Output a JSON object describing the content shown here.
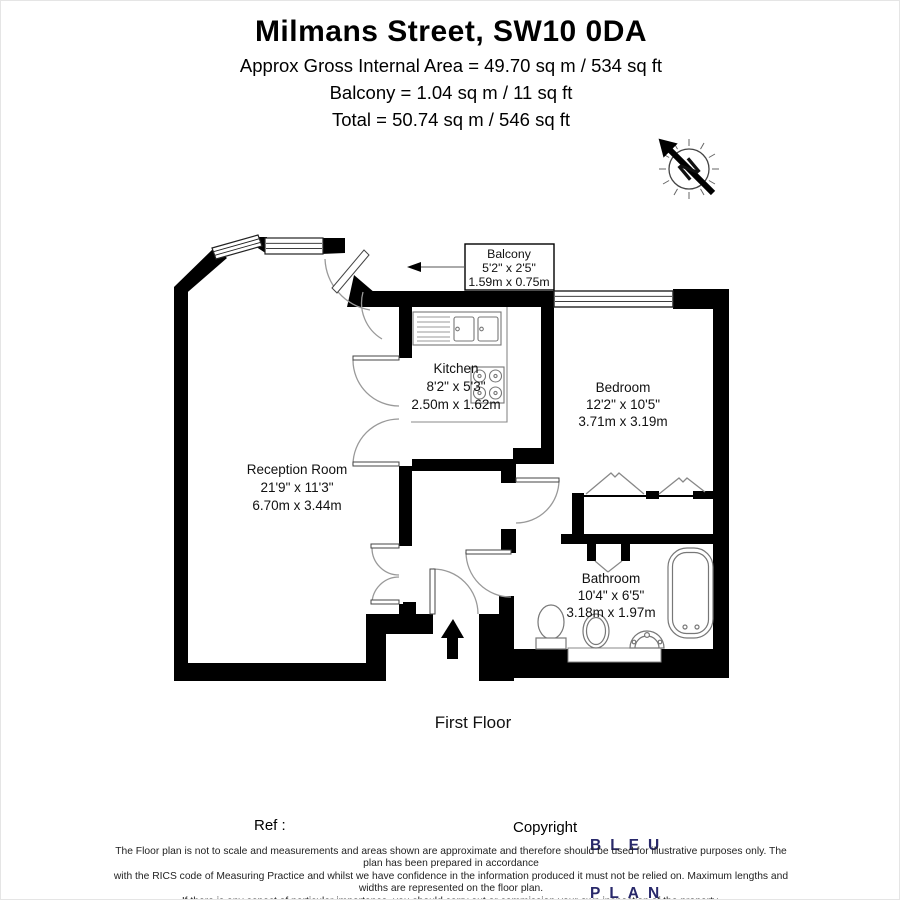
{
  "header": {
    "title": "Milmans Street, SW10 0DA",
    "lines": [
      "Approx Gross Internal Area = 49.70 sq m / 534 sq ft",
      "Balcony = 1.04 sq m / 11 sq ft",
      "Total = 50.74 sq m / 546 sq ft"
    ]
  },
  "compass": {
    "label": "N"
  },
  "rooms": [
    {
      "name": "Reception Room",
      "imperial": "21'9\" x 11'3\"",
      "metric": "6.70m x 3.44m"
    },
    {
      "name": "Kitchen",
      "imperial": "8'2\" x 5'3\"",
      "metric": "2.50m x 1.62m"
    },
    {
      "name": "Bedroom",
      "imperial": "12'2\" x 10'5\"",
      "metric": "3.71m x 3.19m"
    },
    {
      "name": "Bathroom",
      "imperial": "10'4\" x 6'5\"",
      "metric": "3.18m x 1.97m"
    },
    {
      "name": "Balcony",
      "imperial": "5'2\" x 2'5\"",
      "metric": "1.59m x 0.75m"
    }
  ],
  "floor_label": "First Floor",
  "icons": {
    "compass": "north-arrow",
    "entrance": "entrance-arrow-up",
    "balcony_pointer": "arrow-left"
  },
  "colors": {
    "walls": "#000000",
    "logo": "#28286a",
    "fixture_line": "#777777"
  },
  "footer": {
    "ref_label": "Ref :",
    "copyright_label": "Copyright",
    "logo_line1": "BLEU",
    "logo_line2": "PLAN",
    "disclaimer": [
      "The Floor plan is not to scale and measurements and areas shown are approximate and therefore should be used for illustrative purposes only. The plan has been prepared in accordance",
      "with the RICS code of Measuring Practice and whilst we have confidence in the information produced it must not be relied on. Maximum lengths and widths are represented on the floor plan.",
      "If there is any aspect of particular importance, you should carry out or commission your own inspection of the property.",
      "Copyright @ BleuPlan"
    ]
  }
}
